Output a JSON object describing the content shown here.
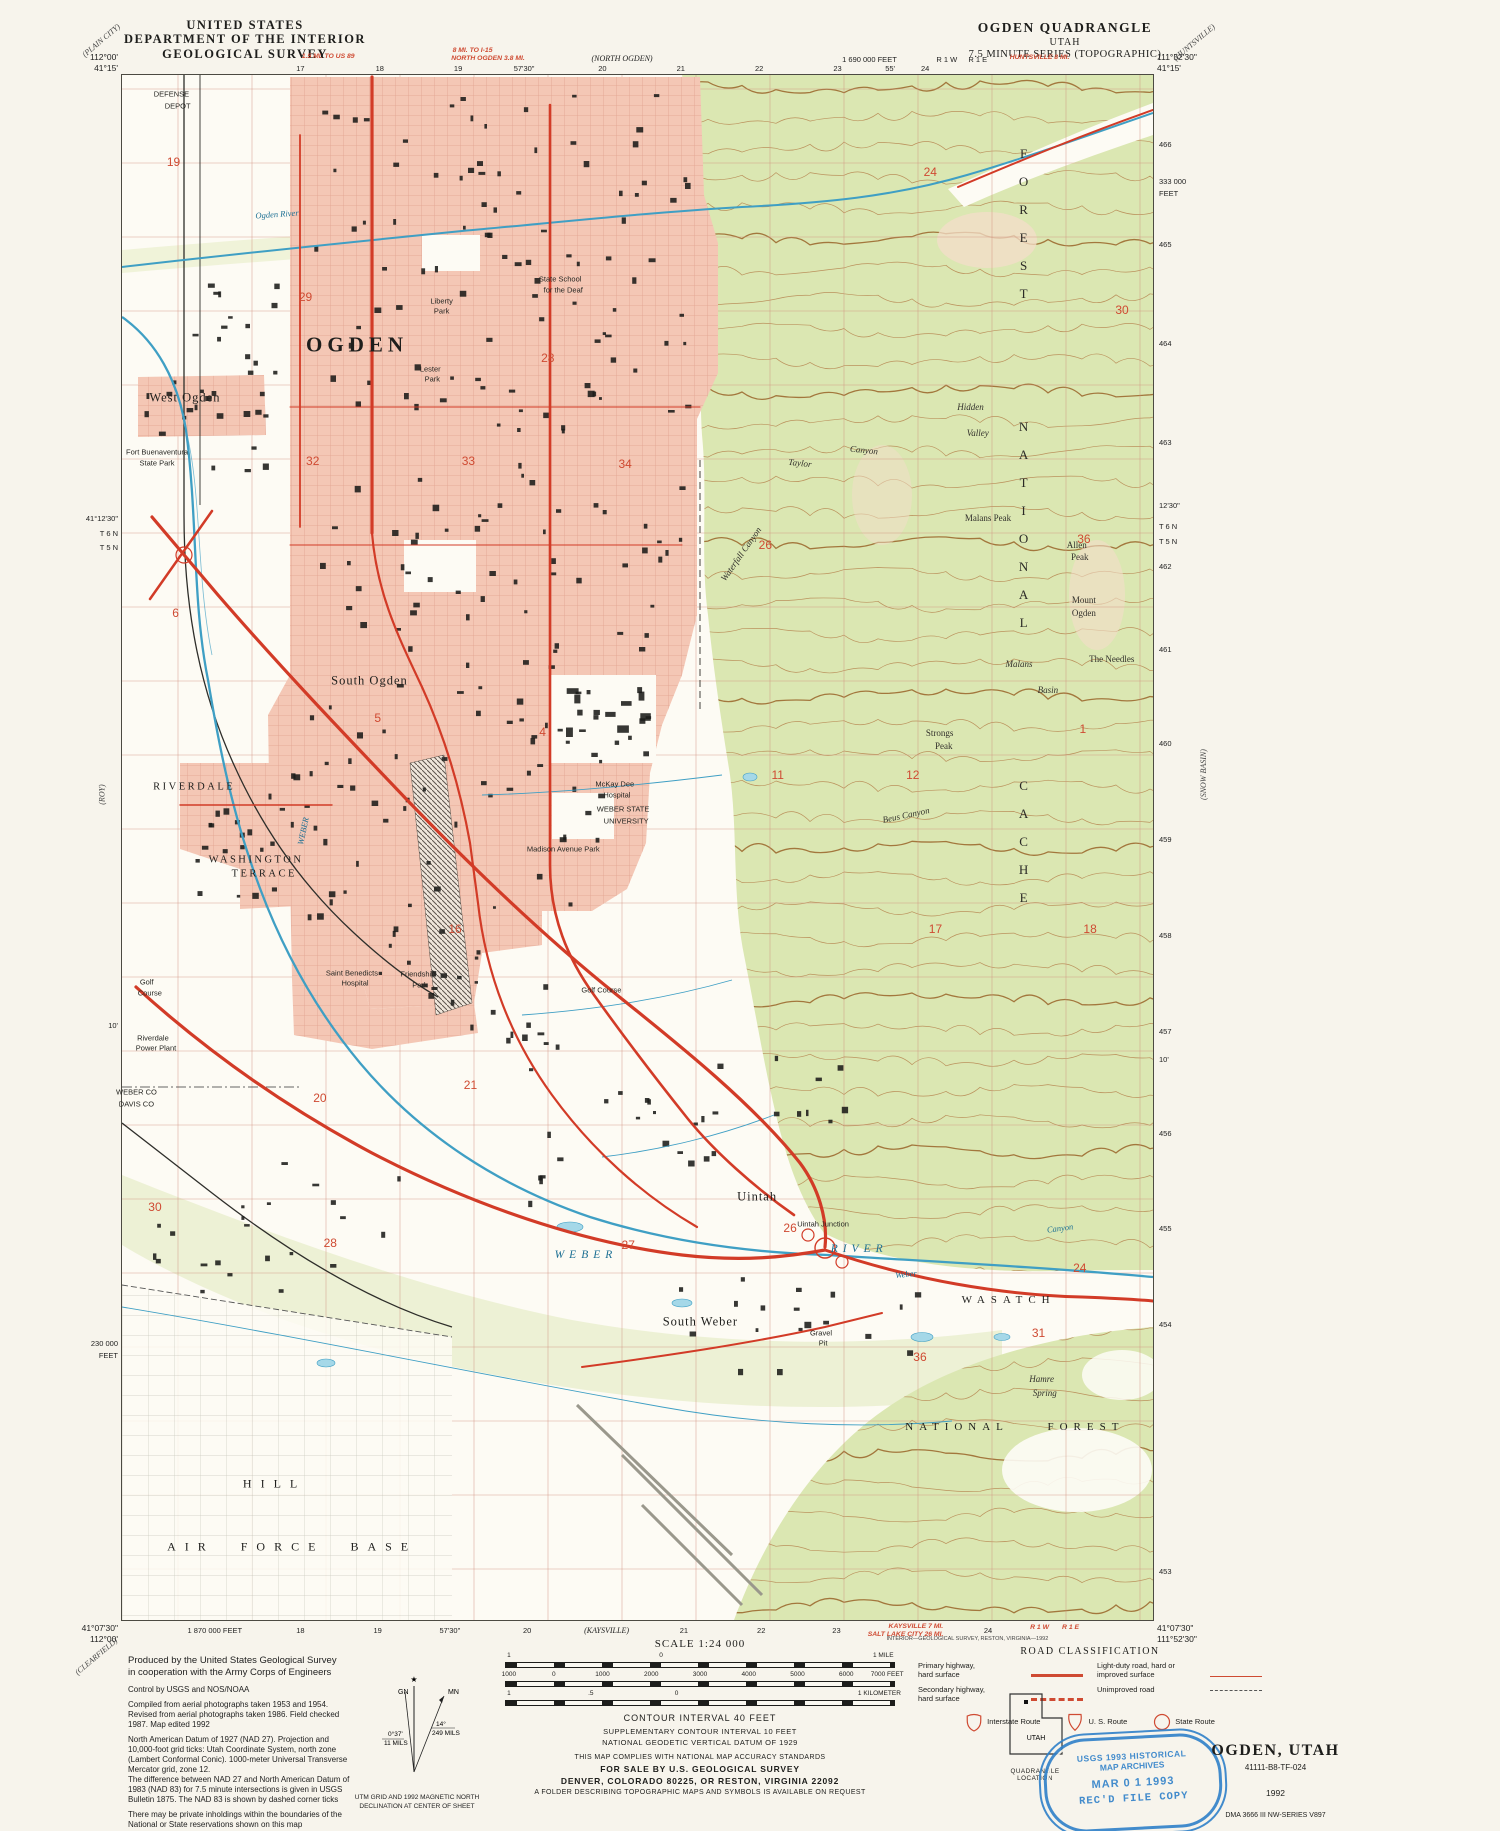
{
  "header": {
    "us1": "UNITED STATES",
    "us2": "DEPARTMENT OF THE INTERIOR",
    "us3": "GEOLOGICAL SURVEY",
    "q1": "OGDEN QUADRANGLE",
    "q2": "UTAH",
    "q3": "7.5 MINUTE SERIES (TOPOGRAPHIC)"
  },
  "corners": {
    "tl_lon": "112°00'",
    "tl_lat": "41°15'",
    "tr_lon": "111°52'30\"",
    "tr_lat": "41°15'",
    "bl_lat": "41°07'30\"",
    "bl_lon": "112°00'",
    "br_lat": "41°07'30\"",
    "br_lon": "111°52'30\""
  },
  "adjoining": {
    "tl": "(PLAIN CITY)",
    "tr": "(HUNTSVILLE)",
    "l": "(ROY)",
    "r": "(SNOW BASIN)",
    "bl": "(CLEARFIELD)"
  },
  "edge": {
    "top": [
      {
        "t": "17",
        "x": 17.3
      },
      {
        "t": "18",
        "x": 25.0
      },
      {
        "t": "19",
        "x": 32.6
      },
      {
        "t": "57'30\"",
        "x": 39.0
      },
      {
        "t": "20",
        "x": 46.6
      },
      {
        "t": "21",
        "x": 54.2
      },
      {
        "t": "22",
        "x": 61.8
      },
      {
        "t": "23",
        "x": 69.4
      },
      {
        "t": "55'",
        "x": 74.5
      },
      {
        "t": "24",
        "x": 77.9
      },
      {
        "t": "1.5 MI. TO US 89",
        "x": 20,
        "c": "ered",
        "y": 3
      },
      {
        "t": "8 MI. TO I-15",
        "x": 34,
        "c": "ered",
        "y": -3
      },
      {
        "t": "NORTH OGDEN 3.8 MI.",
        "x": 35.5,
        "c": "ered",
        "y": 5
      },
      {
        "t": "(NORTH OGDEN)",
        "x": 48.5,
        "c": "eital",
        "y": 4
      },
      {
        "t": "1 690 000 FEET",
        "x": 72.5,
        "y": 5
      },
      {
        "t": "R 1 W",
        "x": 80,
        "y": 5
      },
      {
        "t": "R 1 E",
        "x": 83,
        "y": 5
      },
      {
        "t": "HUNTSVILLE 8 MI.",
        "x": 89,
        "c": "ered",
        "y": 4
      }
    ],
    "bottom": [
      {
        "t": "1 870 000 FEET",
        "x": 9,
        "y": 4
      },
      {
        "t": "18",
        "x": 17.3,
        "y": 4
      },
      {
        "t": "19",
        "x": 24.8,
        "y": 4
      },
      {
        "t": "57'30\"",
        "x": 31.8,
        "y": 4
      },
      {
        "t": "20",
        "x": 39.3,
        "y": 4
      },
      {
        "t": "(KAYSVILLE)",
        "x": 47,
        "c": "eital",
        "y": 4
      },
      {
        "t": "21",
        "x": 54.5,
        "y": 4
      },
      {
        "t": "22",
        "x": 62,
        "y": 4
      },
      {
        "t": "23",
        "x": 69.3,
        "y": 4
      },
      {
        "t": "KAYSVILLE 7 MI.",
        "x": 77,
        "c": "ered",
        "y": 1
      },
      {
        "t": "SALT LAKE CITY 26 MI.",
        "x": 76,
        "c": "ered",
        "y": 9
      },
      {
        "t": "24",
        "x": 84,
        "y": 4
      },
      {
        "t": "R 1 W",
        "x": 89,
        "c": "ered",
        "y": 2
      },
      {
        "t": "R 1 E",
        "x": 92,
        "c": "ered",
        "y": 2
      },
      {
        "t": "INTERIOR—GEOLOGICAL SURVEY, RESTON, VIRGINIA—1992",
        "x": 82,
        "y": 14,
        "c": "etiny"
      }
    ],
    "left": [
      {
        "t": "41°12'30\"",
        "y": 28.4
      },
      {
        "t": "T 6 N",
        "y": 29.4
      },
      {
        "t": "T 5 N",
        "y": 30.3
      },
      {
        "t": "10'",
        "y": 61.2
      },
      {
        "t": "230 000",
        "y": 81.8
      },
      {
        "t": "FEET",
        "y": 82.6
      }
    ],
    "right": [
      {
        "t": "466",
        "y": 4.2
      },
      {
        "t": "333 000",
        "y": 6.6
      },
      {
        "t": "FEET",
        "y": 7.4
      },
      {
        "t": "465",
        "y": 10.7
      },
      {
        "t": "464",
        "y": 17.1
      },
      {
        "t": "463",
        "y": 23.5
      },
      {
        "t": "12'30\"",
        "y": 27.6
      },
      {
        "t": "T 6 N",
        "y": 28.9
      },
      {
        "t": "T 5 N",
        "y": 29.9
      },
      {
        "t": "462",
        "y": 31.5
      },
      {
        "t": "461",
        "y": 36.9
      },
      {
        "t": "460",
        "y": 43.0
      },
      {
        "t": "459",
        "y": 49.2
      },
      {
        "t": "458",
        "y": 55.4
      },
      {
        "t": "457",
        "y": 61.6
      },
      {
        "t": "10'",
        "y": 63.4
      },
      {
        "t": "456",
        "y": 68.2
      },
      {
        "t": "455",
        "y": 74.4
      },
      {
        "t": "454",
        "y": 80.6
      },
      {
        "t": "453",
        "y": 96.6
      }
    ]
  },
  "map": {
    "labels": [
      {
        "t": "DEFENSE",
        "x": 4.8,
        "y": 1.2,
        "c": "feat"
      },
      {
        "t": "DEPOT",
        "x": 5.4,
        "y": 2.0,
        "c": "feat"
      },
      {
        "t": "OGDEN",
        "x": 22.8,
        "y": 17.5,
        "c": "city"
      },
      {
        "t": "West Ogden",
        "x": 6.1,
        "y": 20.9,
        "c": "place"
      },
      {
        "t": "South Ogden",
        "x": 24.0,
        "y": 39.2,
        "c": "place"
      },
      {
        "t": "RIVERDALE",
        "x": 7.0,
        "y": 46.1,
        "c": "place2"
      },
      {
        "t": "WASHINGTON",
        "x": 13.0,
        "y": 50.8,
        "c": "place2"
      },
      {
        "t": "TERRACE",
        "x": 13.8,
        "y": 51.7,
        "c": "place2"
      },
      {
        "t": "South Weber",
        "x": 56.1,
        "y": 80.7,
        "c": "place"
      },
      {
        "t": "Uintah",
        "x": 61.6,
        "y": 72.6,
        "c": "place"
      },
      {
        "t": "Uintah Junction",
        "x": 68.0,
        "y": 74.4,
        "c": "feat"
      },
      {
        "t": "HILL",
        "x": 14.8,
        "y": 91.2,
        "c": "spread"
      },
      {
        "t": "AIR FORCE BASE",
        "x": 16.5,
        "y": 95.3,
        "c": "spread"
      },
      {
        "t": "WEBER",
        "x": 45.0,
        "y": 76.4,
        "c": "riv"
      },
      {
        "t": "RIVER",
        "x": 71.5,
        "y": 76.0,
        "c": "riv"
      },
      {
        "t": "WEBER",
        "x": 17.6,
        "y": 48.9,
        "c": "rivsm",
        "r": -78
      },
      {
        "t": "Ogden River",
        "x": 15.0,
        "y": 9.0,
        "c": "rivsm",
        "r": -4
      },
      {
        "t": "Weber",
        "x": 76.0,
        "y": 77.6,
        "c": "rivsm",
        "r": -6
      },
      {
        "t": "Canyon",
        "x": 91.0,
        "y": 74.6,
        "c": "rivsm",
        "r": -8
      },
      {
        "t": "Liberty",
        "x": 31.0,
        "y": 14.6,
        "c": "feat"
      },
      {
        "t": "Park",
        "x": 31.0,
        "y": 15.3,
        "c": "feat"
      },
      {
        "t": "Lester",
        "x": 29.9,
        "y": 19.0,
        "c": "feat"
      },
      {
        "t": "Park",
        "x": 30.1,
        "y": 19.7,
        "c": "feat"
      },
      {
        "t": "State School",
        "x": 42.5,
        "y": 13.2,
        "c": "feat"
      },
      {
        "t": "for the Deaf",
        "x": 42.8,
        "y": 13.9,
        "c": "feat"
      },
      {
        "t": "Fort Buenaventura",
        "x": 3.4,
        "y": 24.4,
        "c": "feat"
      },
      {
        "t": "State Park",
        "x": 3.4,
        "y": 25.1,
        "c": "feat"
      },
      {
        "t": "McKay Dee",
        "x": 47.8,
        "y": 45.9,
        "c": "feat"
      },
      {
        "t": "Hospital",
        "x": 48.0,
        "y": 46.6,
        "c": "feat"
      },
      {
        "t": "WEBER STATE",
        "x": 48.6,
        "y": 47.5,
        "c": "feat"
      },
      {
        "t": "UNIVERSITY",
        "x": 48.9,
        "y": 48.3,
        "c": "feat"
      },
      {
        "t": "Saint Benedicts",
        "x": 22.3,
        "y": 58.1,
        "c": "feat"
      },
      {
        "t": "Hospital",
        "x": 22.6,
        "y": 58.8,
        "c": "feat"
      },
      {
        "t": "Friendship",
        "x": 28.7,
        "y": 58.2,
        "c": "feat"
      },
      {
        "t": "Park",
        "x": 28.9,
        "y": 58.9,
        "c": "feat"
      },
      {
        "t": "Golf Course",
        "x": 46.5,
        "y": 59.2,
        "c": "feat"
      },
      {
        "t": "Golf",
        "x": 2.4,
        "y": 58.7,
        "c": "feat"
      },
      {
        "t": "Course",
        "x": 2.7,
        "y": 59.4,
        "c": "feat"
      },
      {
        "t": "Riverdale",
        "x": 3.0,
        "y": 62.3,
        "c": "feat"
      },
      {
        "t": "Power Plant",
        "x": 3.3,
        "y": 63.0,
        "c": "feat"
      },
      {
        "t": "Madison Avenue Park",
        "x": 42.8,
        "y": 50.1,
        "c": "feat"
      },
      {
        "t": "WEBER CO",
        "x": 1.4,
        "y": 65.8,
        "c": "feat"
      },
      {
        "t": "DAVIS CO",
        "x": 1.4,
        "y": 66.6,
        "c": "feat"
      },
      {
        "t": "Gravel",
        "x": 67.8,
        "y": 81.4,
        "c": "feat"
      },
      {
        "t": "Pit",
        "x": 68.0,
        "y": 82.1,
        "c": "feat"
      },
      {
        "t": "Hidden",
        "x": 82.3,
        "y": 21.5,
        "c": "mtni"
      },
      {
        "t": "Valley",
        "x": 83.0,
        "y": 23.2,
        "c": "mtni"
      },
      {
        "t": "Taylor",
        "x": 65.8,
        "y": 25.1,
        "c": "mtni",
        "r": 6
      },
      {
        "t": "Canyon",
        "x": 72.0,
        "y": 24.3,
        "c": "mtni",
        "r": 6
      },
      {
        "t": "Waterfall Canyon",
        "x": 60.0,
        "y": 31.0,
        "c": "mtni",
        "r": -55
      },
      {
        "t": "Malans",
        "x": 87.0,
        "y": 38.1,
        "c": "mtni"
      },
      {
        "t": "Basin",
        "x": 89.8,
        "y": 39.8,
        "c": "mtni"
      },
      {
        "t": "Malans Peak",
        "x": 84.0,
        "y": 28.7,
        "c": "mtn"
      },
      {
        "t": "Allen",
        "x": 92.6,
        "y": 30.4,
        "c": "mtn"
      },
      {
        "t": "Peak",
        "x": 92.9,
        "y": 31.2,
        "c": "mtn"
      },
      {
        "t": "Mount",
        "x": 93.3,
        "y": 34.0,
        "c": "mtn"
      },
      {
        "t": "Ogden",
        "x": 93.3,
        "y": 34.8,
        "c": "mtn"
      },
      {
        "t": "Strongs",
        "x": 79.3,
        "y": 42.6,
        "c": "mtn"
      },
      {
        "t": "Peak",
        "x": 79.7,
        "y": 43.4,
        "c": "mtn"
      },
      {
        "t": "The Needles",
        "x": 96.0,
        "y": 37.8,
        "c": "mtn"
      },
      {
        "t": "Beus Canyon",
        "x": 76.0,
        "y": 47.9,
        "c": "mtni",
        "r": -12
      },
      {
        "t": "Hamre",
        "x": 89.2,
        "y": 84.4,
        "c": "mtni"
      },
      {
        "t": "Spring",
        "x": 89.5,
        "y": 85.3,
        "c": "mtni"
      },
      {
        "t": "CACHE",
        "x": 87.4,
        "y": 50.0,
        "c": "vert"
      },
      {
        "t": "NATIONAL",
        "x": 87.4,
        "y": 29.5,
        "c": "vert"
      },
      {
        "t": "FOREST",
        "x": 87.4,
        "y": 10.0,
        "c": "vert"
      },
      {
        "t": "WASATCH",
        "x": 86.0,
        "y": 79.3,
        "c": "spread2"
      },
      {
        "t": "NATIONAL",
        "x": 81.0,
        "y": 87.5,
        "c": "spread2"
      },
      {
        "t": "FOREST",
        "x": 93.5,
        "y": 87.5,
        "c": "spread2"
      }
    ],
    "sections": [
      {
        "n": "19",
        "x": 5.0,
        "y": 5.6
      },
      {
        "n": "24",
        "x": 78.4,
        "y": 6.3
      },
      {
        "n": "29",
        "x": 17.8,
        "y": 14.4
      },
      {
        "n": "28",
        "x": 41.3,
        "y": 18.3
      },
      {
        "n": "30",
        "x": 97.0,
        "y": 15.2
      },
      {
        "n": "32",
        "x": 18.5,
        "y": 25.0
      },
      {
        "n": "33",
        "x": 33.6,
        "y": 25.0
      },
      {
        "n": "34",
        "x": 48.8,
        "y": 25.2
      },
      {
        "n": "26",
        "x": 62.4,
        "y": 30.4
      },
      {
        "n": "36",
        "x": 93.3,
        "y": 30.0
      },
      {
        "n": "6",
        "x": 5.2,
        "y": 34.8
      },
      {
        "n": "5",
        "x": 24.8,
        "y": 41.6
      },
      {
        "n": "4",
        "x": 40.8,
        "y": 42.5
      },
      {
        "n": "1",
        "x": 93.2,
        "y": 42.3
      },
      {
        "n": "11",
        "x": 63.6,
        "y": 45.3
      },
      {
        "n": "12",
        "x": 76.7,
        "y": 45.3
      },
      {
        "n": "16",
        "x": 32.3,
        "y": 55.3
      },
      {
        "n": "17",
        "x": 78.9,
        "y": 55.3
      },
      {
        "n": "18",
        "x": 93.9,
        "y": 55.3
      },
      {
        "n": "20",
        "x": 19.2,
        "y": 66.2
      },
      {
        "n": "21",
        "x": 33.8,
        "y": 65.4
      },
      {
        "n": "30",
        "x": 3.2,
        "y": 73.3
      },
      {
        "n": "26",
        "x": 64.8,
        "y": 74.6
      },
      {
        "n": "27",
        "x": 49.1,
        "y": 75.7
      },
      {
        "n": "28",
        "x": 20.2,
        "y": 75.6
      },
      {
        "n": "24",
        "x": 92.9,
        "y": 77.2
      },
      {
        "n": "31",
        "x": 88.9,
        "y": 81.4
      },
      {
        "n": "36",
        "x": 77.4,
        "y": 83.0
      }
    ]
  },
  "footer": {
    "credits": [
      {
        "c": "big",
        "t": "Produced by the United States Geological Survey"
      },
      {
        "c": "big",
        "t": "in cooperation with the Army Corps of Engineers"
      },
      {
        "c": "gap",
        "t": "Control by USGS and NOS/NOAA"
      },
      {
        "c": "gap",
        "t": "Compiled from aerial photographs taken 1953 and 1954. Revised from aerial photographs taken 1986. Field checked 1987. Map edited 1992"
      },
      {
        "c": "gap",
        "t": "North American Datum of 1927 (NAD 27). Projection and 10,000-foot grid ticks: Utah Coordinate System, north zone (Lambert Conformal Conic). 1000-meter Universal Transverse Mercator grid, zone 12."
      },
      {
        "c": "",
        "t": "The difference between NAD 27 and North American Datum of 1983 (NAD 83) for 7.5 minute intersections is given in USGS Bulletin 1875. The NAD 83 is shown by dashed corner ticks"
      },
      {
        "c": "gap",
        "t": "There may be private inholdings within the boundaries of the National or State reservations shown on this map"
      },
      {
        "c": "gap",
        "t": "Red tint indicates areas in which only landmark buildings are shown"
      }
    ]
  },
  "declination": {
    "note1": "UTM GRID AND 1992 MAGNETIC NORTH",
    "note2": "DECLINATION AT CENTER OF SHEET",
    "gn": "GN",
    "mn": "MN",
    "gn_deg": "0°37'",
    "gn_mils": "11 MILS",
    "mn_deg": "14°",
    "mn_mils": "249 MILS"
  },
  "scalebar": {
    "label": "SCALE 1:24 000",
    "mile": [
      {
        "t": "1",
        "p": 1
      },
      {
        "t": "0",
        "p": 40
      },
      {
        "t": "1 MILE",
        "p": 97
      }
    ],
    "feet": [
      {
        "t": "1000",
        "p": 1
      },
      {
        "t": "0",
        "p": 12.5
      },
      {
        "t": "1000",
        "p": 25
      },
      {
        "t": "2000",
        "p": 37.5
      },
      {
        "t": "3000",
        "p": 50
      },
      {
        "t": "4000",
        "p": 62.5
      },
      {
        "t": "5000",
        "p": 75
      },
      {
        "t": "6000",
        "p": 87.5
      },
      {
        "t": "7000 FEET",
        "p": 98
      }
    ],
    "km": [
      {
        "t": "1",
        "p": 1
      },
      {
        "t": ".5",
        "p": 22
      },
      {
        "t": "0",
        "p": 44
      },
      {
        "t": "1 KILOMETER",
        "p": 96
      }
    ]
  },
  "contour": {
    "l1": "CONTOUR INTERVAL 40 FEET",
    "l2": "SUPPLEMENTARY CONTOUR INTERVAL 10 FEET",
    "l3": "NATIONAL GEODETIC VERTICAL DATUM OF 1929"
  },
  "notes": {
    "accuracy": "THIS MAP COMPLIES WITH NATIONAL MAP ACCURACY STANDARDS",
    "sale1": "FOR SALE BY U.S. GEOLOGICAL SURVEY",
    "sale2": "DENVER, COLORADO 80225, OR RESTON, VIRGINIA 22092",
    "sale3": "A FOLDER DESCRIBING TOPOGRAPHIC MAPS AND SYMBOLS IS AVAILABLE ON REQUEST"
  },
  "road_class": {
    "title": "ROAD CLASSIFICATION",
    "col1": [
      {
        "l1": "Primary highway,",
        "l2": "hard surface",
        "sw": "primary"
      },
      {
        "l1": "Secondary highway,",
        "l2": "hard surface",
        "sw": "secondary"
      }
    ],
    "col2": [
      {
        "l1": "Light-duty road, hard or",
        "l2": "improved surface",
        "sw": "light"
      },
      {
        "l1": "Unimproved road",
        "l2": "",
        "sw": "unimproved"
      }
    ],
    "routes": [
      {
        "label": "Interstate Route",
        "shield": "interstate"
      },
      {
        "label": "U. S. Route",
        "shield": "us"
      },
      {
        "label": "State Route",
        "shield": "state"
      }
    ]
  },
  "quad_location": {
    "state": "UTAH",
    "caption": "QUADRANGLE LOCATION"
  },
  "stamp": {
    "l1": "USGS 1993 HISTORICAL",
    "l2": "MAP ARCHIVES",
    "l3": "MAR 0 1 1993",
    "l4": "REC'D FILE COPY"
  },
  "title_block": {
    "title": "OGDEN, UTAH",
    "code": "41111-B8-TF-024",
    "year": "1992",
    "dma": "DMA 3666 III NW-SERIES V897"
  },
  "colors": {
    "urban_tint": "#f4c7b5",
    "forest": "#dbe7b2",
    "highway_red": "#d23b27",
    "water_blue": "#3f9fc4",
    "contour_brown": "#b5824d",
    "stamp_blue": "#2f80c9"
  }
}
